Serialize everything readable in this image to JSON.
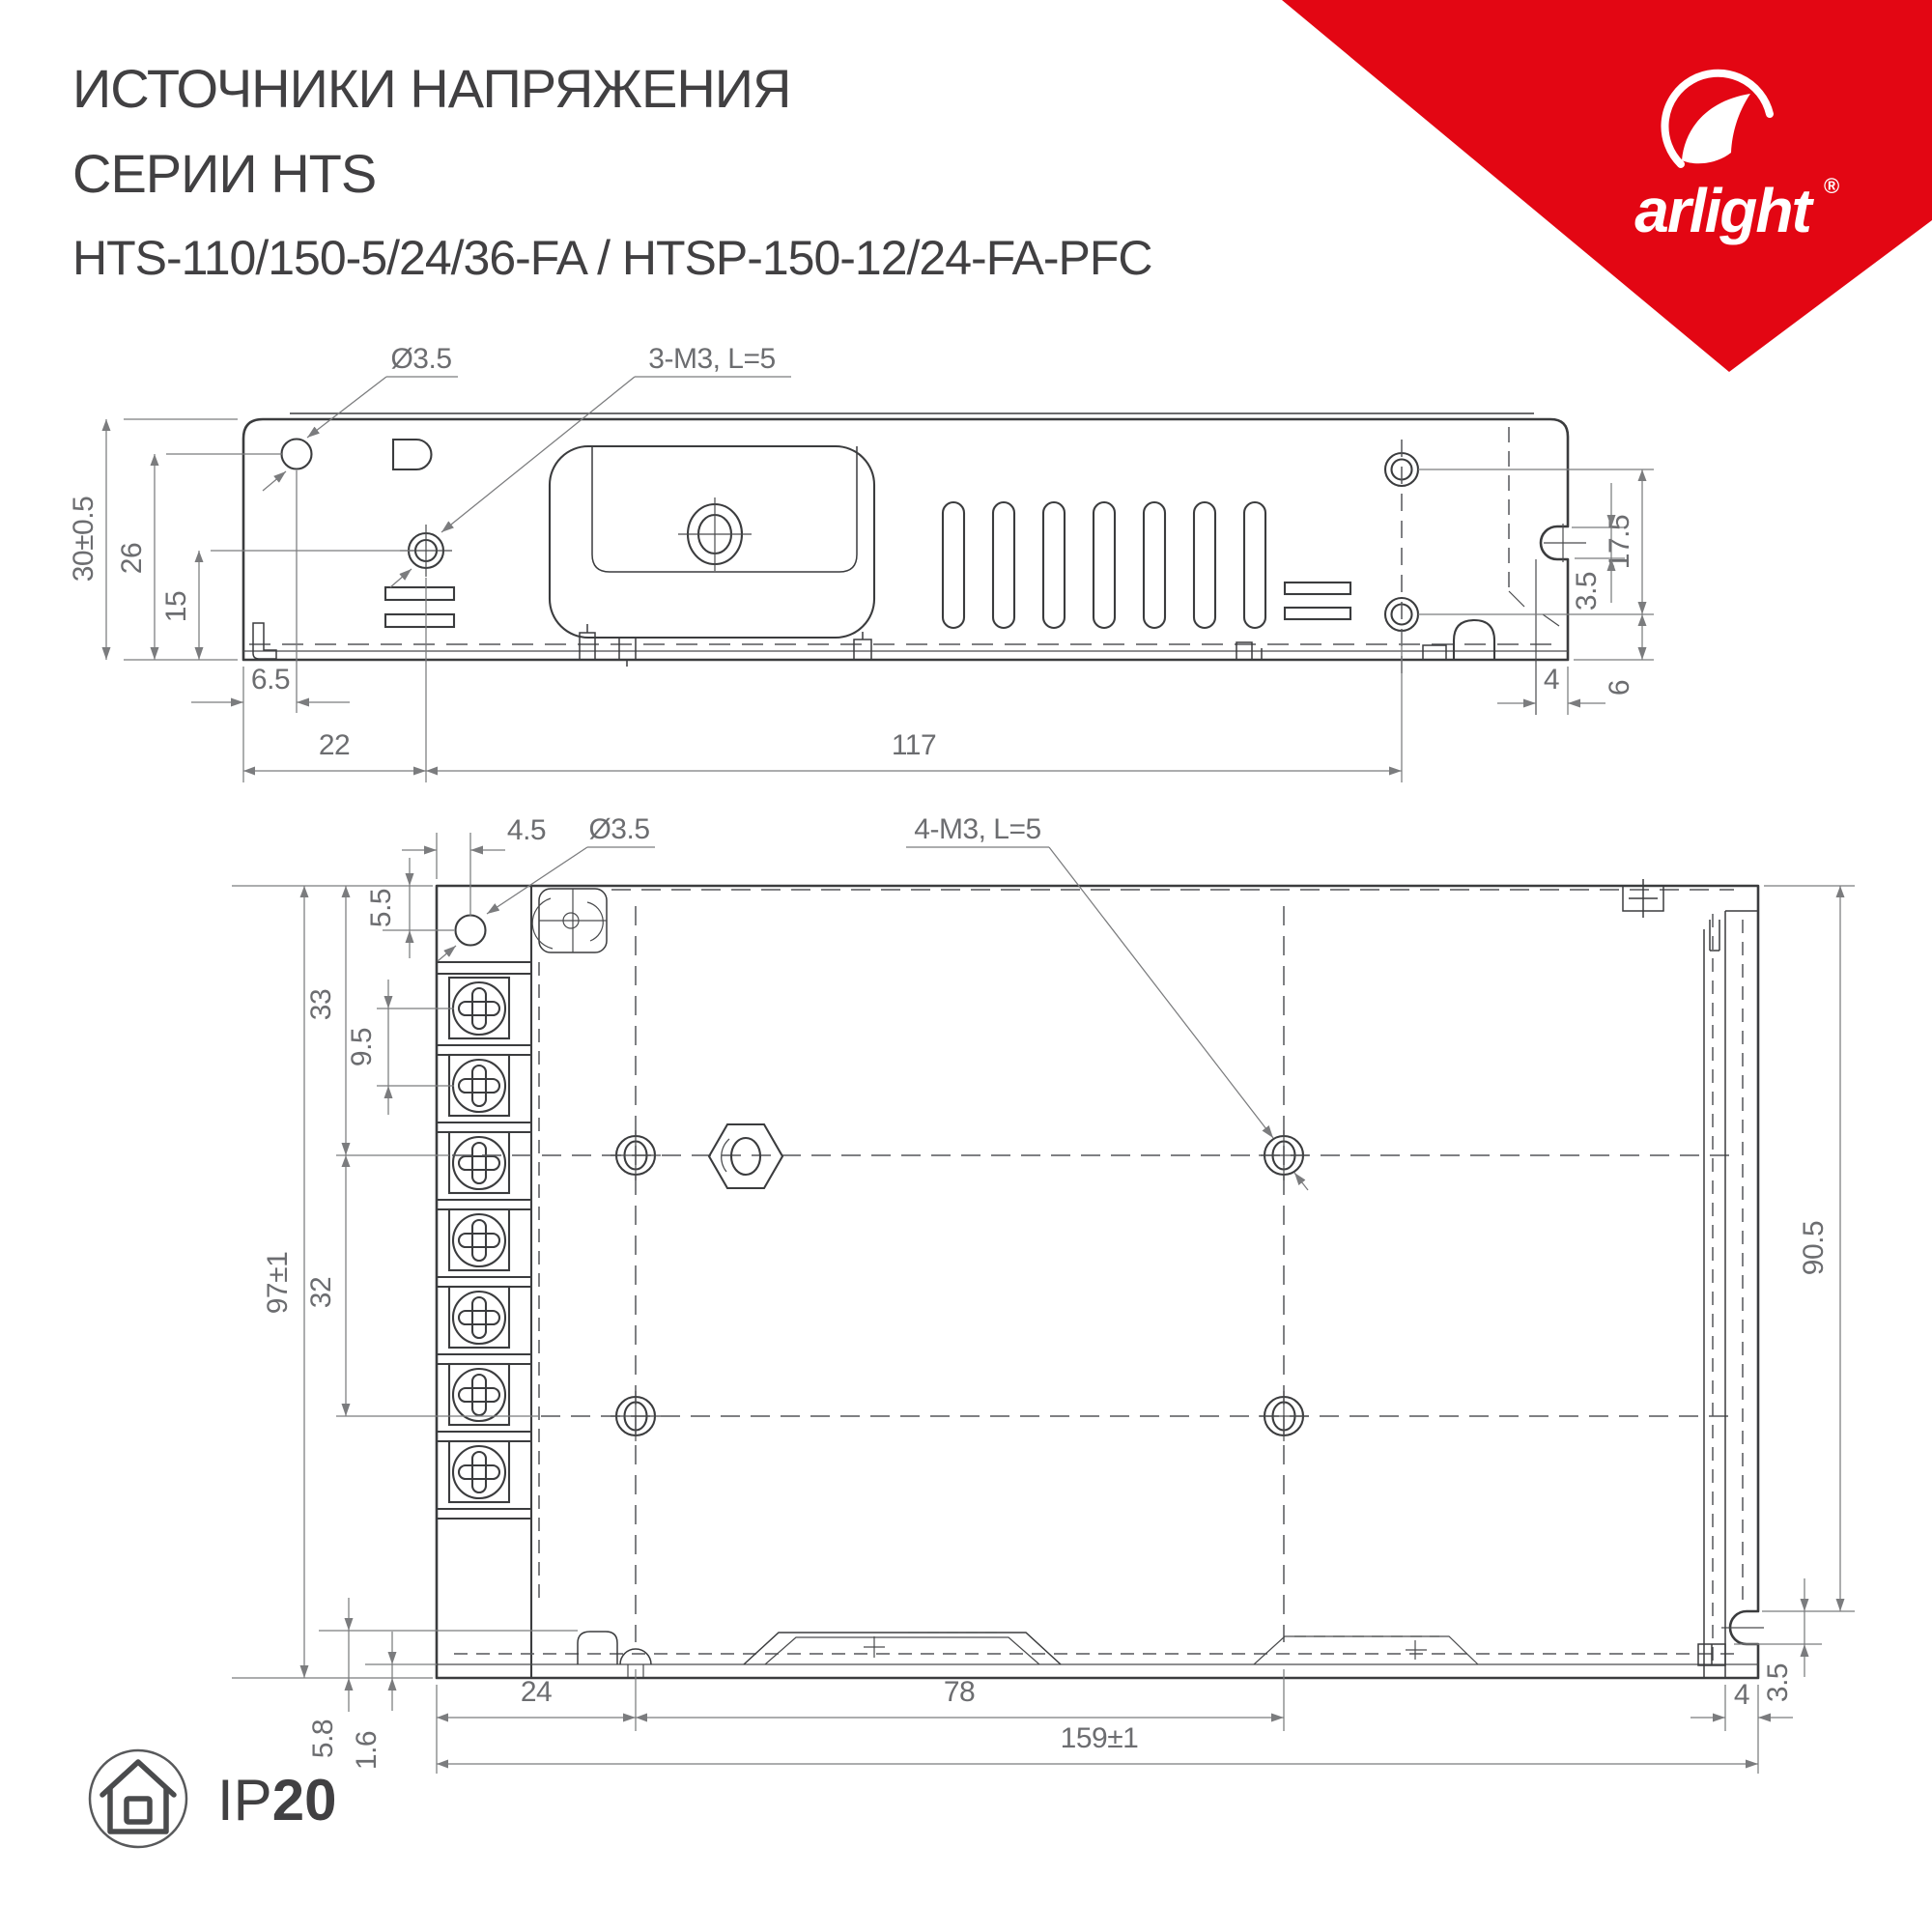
{
  "header": {
    "title_line1": "ИСТОЧНИКИ НАПРЯЖЕНИЯ",
    "title_line2": "СЕРИИ HTS",
    "title_line3": "HTS-110/150-5/24/36-FA / HTSP-150-12/24-FA-PFC"
  },
  "logo": {
    "brand": "arlight",
    "registered": "®",
    "accent_color": "#e30613"
  },
  "side_view": {
    "callout_hole": "Ø3.5",
    "callout_screws": "3-M3, L=5",
    "dim_height_overall": "30±0.5",
    "dim_hole_from_bottom": "26",
    "dim_screw_from_bottom": "15",
    "dim_hole_from_left": "6.5",
    "dim_screw_from_left": "22",
    "dim_mount_span": "117",
    "dim_right_holes_span": "17.5",
    "dim_notch": "3.5",
    "dim_bottom_hole_offset": "6",
    "dim_lip": "4"
  },
  "plan_view": {
    "callout_hole": "Ø3.5",
    "callout_screws": "4-M3, L=5",
    "dim_hole_from_left": "4.5",
    "dim_hole_from_top": "5.5",
    "dim_row1_from_top": "33",
    "dim_terminal_pitch": "9.5",
    "dim_height_overall": "97±1",
    "dim_row_span": "32",
    "dim_depth": "90.5",
    "dim_col1_offset": "24",
    "dim_col_span": "78",
    "dim_length_overall": "159±1",
    "dim_tab_height": "5.8",
    "dim_sheet_thickness": "1.6",
    "dim_notch": "3.5",
    "dim_lip": "4"
  },
  "footer": {
    "ip_prefix": "IP",
    "ip_value": "20"
  }
}
